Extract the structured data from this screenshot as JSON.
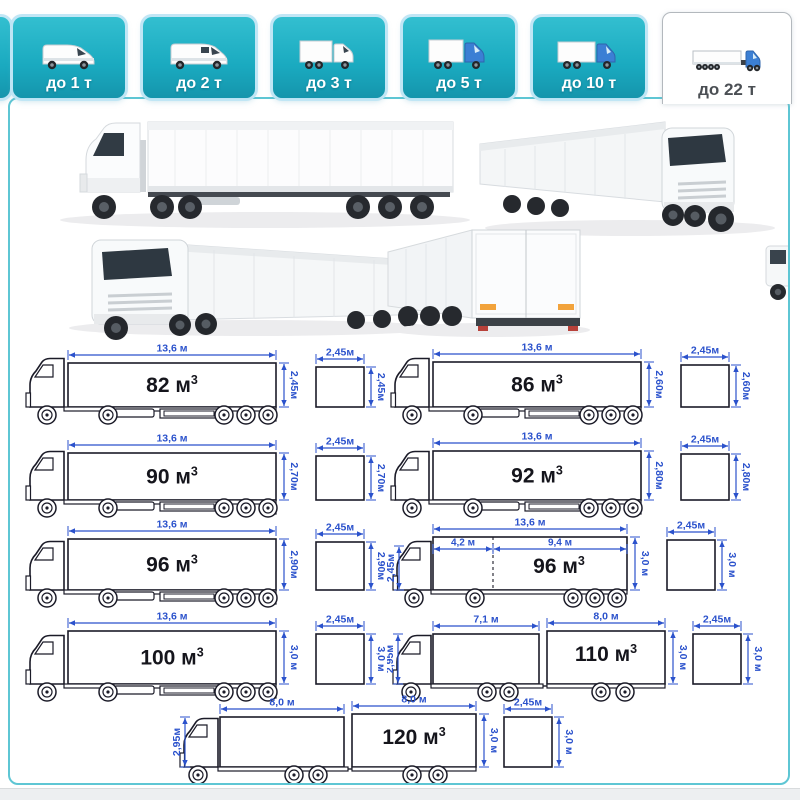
{
  "tabs": [
    {
      "label": "до 1 т",
      "icon": "van-small-icon",
      "selected": false
    },
    {
      "label": "до 2 т",
      "icon": "van-large-icon",
      "selected": false
    },
    {
      "label": "до 3 т",
      "icon": "box-truck-white-icon",
      "selected": false
    },
    {
      "label": "до 5 т",
      "icon": "box-truck-blue-icon",
      "selected": false
    },
    {
      "label": "до 10 т",
      "icon": "box-truck-blue-long-icon",
      "selected": false
    },
    {
      "label": "до 22 т",
      "icon": "semi-truck-icon",
      "selected": true
    }
  ],
  "colors": {
    "tab_teal": "#1cb0c5",
    "tab_selected_text": "#4b4f54",
    "dimension_blue": "#2b52cc",
    "line_art": "#1b1b28",
    "panel_border": "#5ec6d4"
  },
  "photos": [
    {
      "name": "semi-truck-side-view"
    },
    {
      "name": "semi-truck-front-quarter-view"
    },
    {
      "name": "semi-truck-front-quarter-view-2"
    },
    {
      "name": "semi-truck-rear-quarter-view"
    }
  ],
  "diagrams": [
    {
      "variant": "semi",
      "length": "13,6 м",
      "volume": "82",
      "height": "2,45м",
      "cross_width": "2,45м",
      "cross_height": "2,45м"
    },
    {
      "variant": "semi",
      "length": "13,6 м",
      "volume": "86",
      "height": "2,60м",
      "cross_width": "2,45м",
      "cross_height": "2,60м"
    },
    {
      "variant": "semi",
      "length": "13,6 м",
      "volume": "90",
      "height": "2,70м",
      "cross_width": "2,45м",
      "cross_height": "2,70м"
    },
    {
      "variant": "semi",
      "length": "13,6 м",
      "volume": "92",
      "height": "2,80м",
      "cross_width": "2,45м",
      "cross_height": "2,80м"
    },
    {
      "variant": "semi",
      "length": "13,6 м",
      "volume": "96",
      "height": "2,90м",
      "cross_width": "2,45м",
      "cross_height": "2,90м"
    },
    {
      "variant": "jumbo",
      "length": "13,6 м",
      "splits": [
        "4,2 м",
        "9,4 м"
      ],
      "volume": "96",
      "height": "3,0 м",
      "height_left": "2,45м",
      "cross_width": "2,45м",
      "cross_height": "3,0 м"
    },
    {
      "variant": "semi",
      "length": "13,6 м",
      "volume": "100",
      "height": "3,0 м",
      "cross_width": "2,45м",
      "cross_height": "3,0 м"
    },
    {
      "variant": "train",
      "splits": [
        "7,1 м",
        "8,0 м"
      ],
      "volume": "110",
      "height": "3,0 м",
      "height_left": "2,95м",
      "cross_width": "2,45м",
      "cross_height": "3,0 м"
    },
    {
      "variant": "train",
      "splits": [
        "8,0 м",
        "8,0 м"
      ],
      "volume": "120",
      "height": "3,0 м",
      "height_left": "2,95м",
      "cross_width": "2,45м",
      "cross_height": "3,0 м"
    }
  ],
  "volume_unit": "м",
  "volume_sup": "3"
}
